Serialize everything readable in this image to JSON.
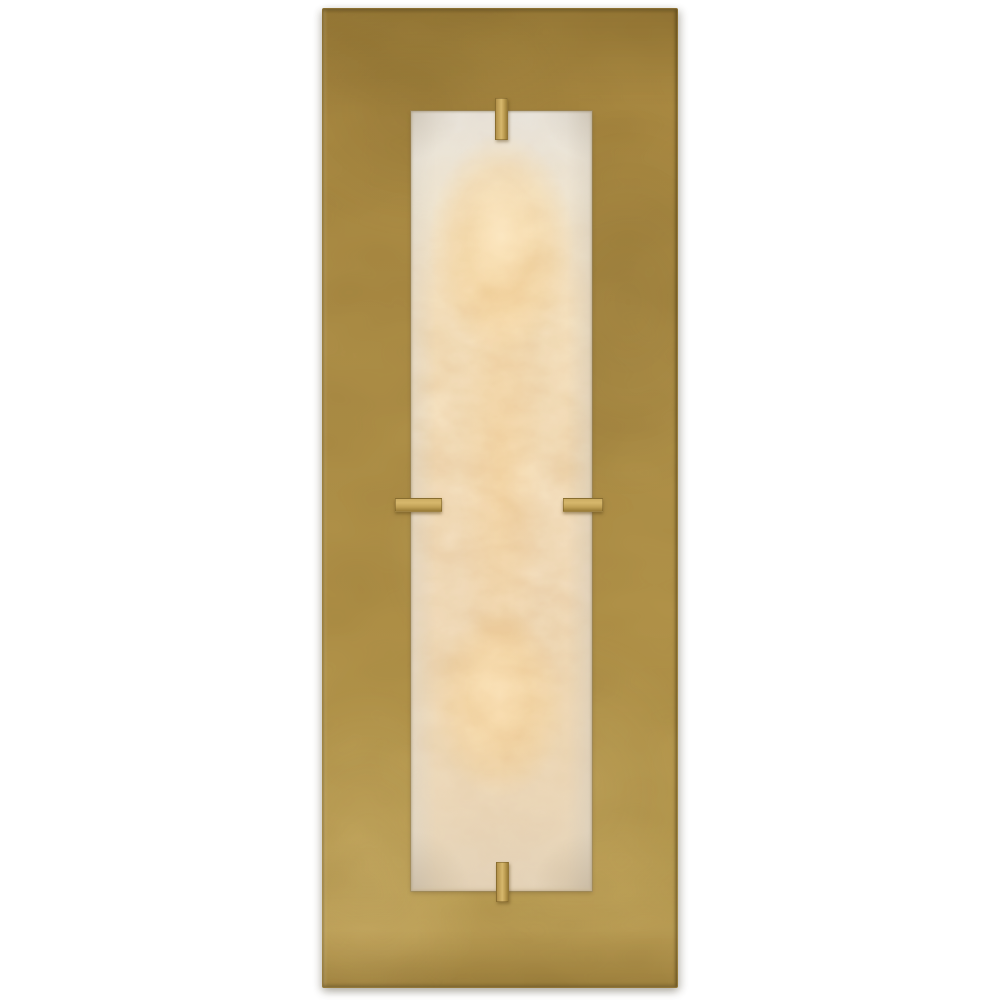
{
  "image": {
    "type": "product-photograph",
    "alt": "Rectangular wall sconce: a tall hand-rubbed brass backplate with a glowing rectangular alabaster diffuser panel mounted on it, held by four small brass clips (top, bottom, left, right), photographed on a plain white background while lit from within",
    "background": "plain white"
  },
  "sconce": {
    "backplate_shape": "tall vertical rectangle",
    "backplate_finish": "brass / antique gold",
    "diffuser_shape": "tall vertical rectangle",
    "diffuser_material_look": "veined alabaster, warmly backlit",
    "clip_count": 4,
    "clip_positions": [
      "top-center",
      "bottom-center",
      "left-middle",
      "right-middle"
    ],
    "lit": true,
    "glow_hotspots": 2
  },
  "colors": {
    "bg": "#ffffff",
    "brass-top": "#a5853d",
    "brass-mid": "#ae8f47",
    "brass-bottom": "#b79a4f",
    "brass-edge-light": "#cdb06a",
    "brass-edge-dark": "#7c6128",
    "clip-light": "#d6b76c",
    "clip-mid": "#c1a156",
    "clip-dark": "#9a7c36",
    "panel-cool": "#e8e3db",
    "panel-warm": "#f5e2c0",
    "panel-bottom": "#e4d3b9",
    "glow-core": "#fce1aa",
    "glow-soft": "#f7d7a6",
    "vein-tan": "#d6b388",
    "panel-border": "#a59678",
    "drop-shadow": "#d9d9d6"
  }
}
